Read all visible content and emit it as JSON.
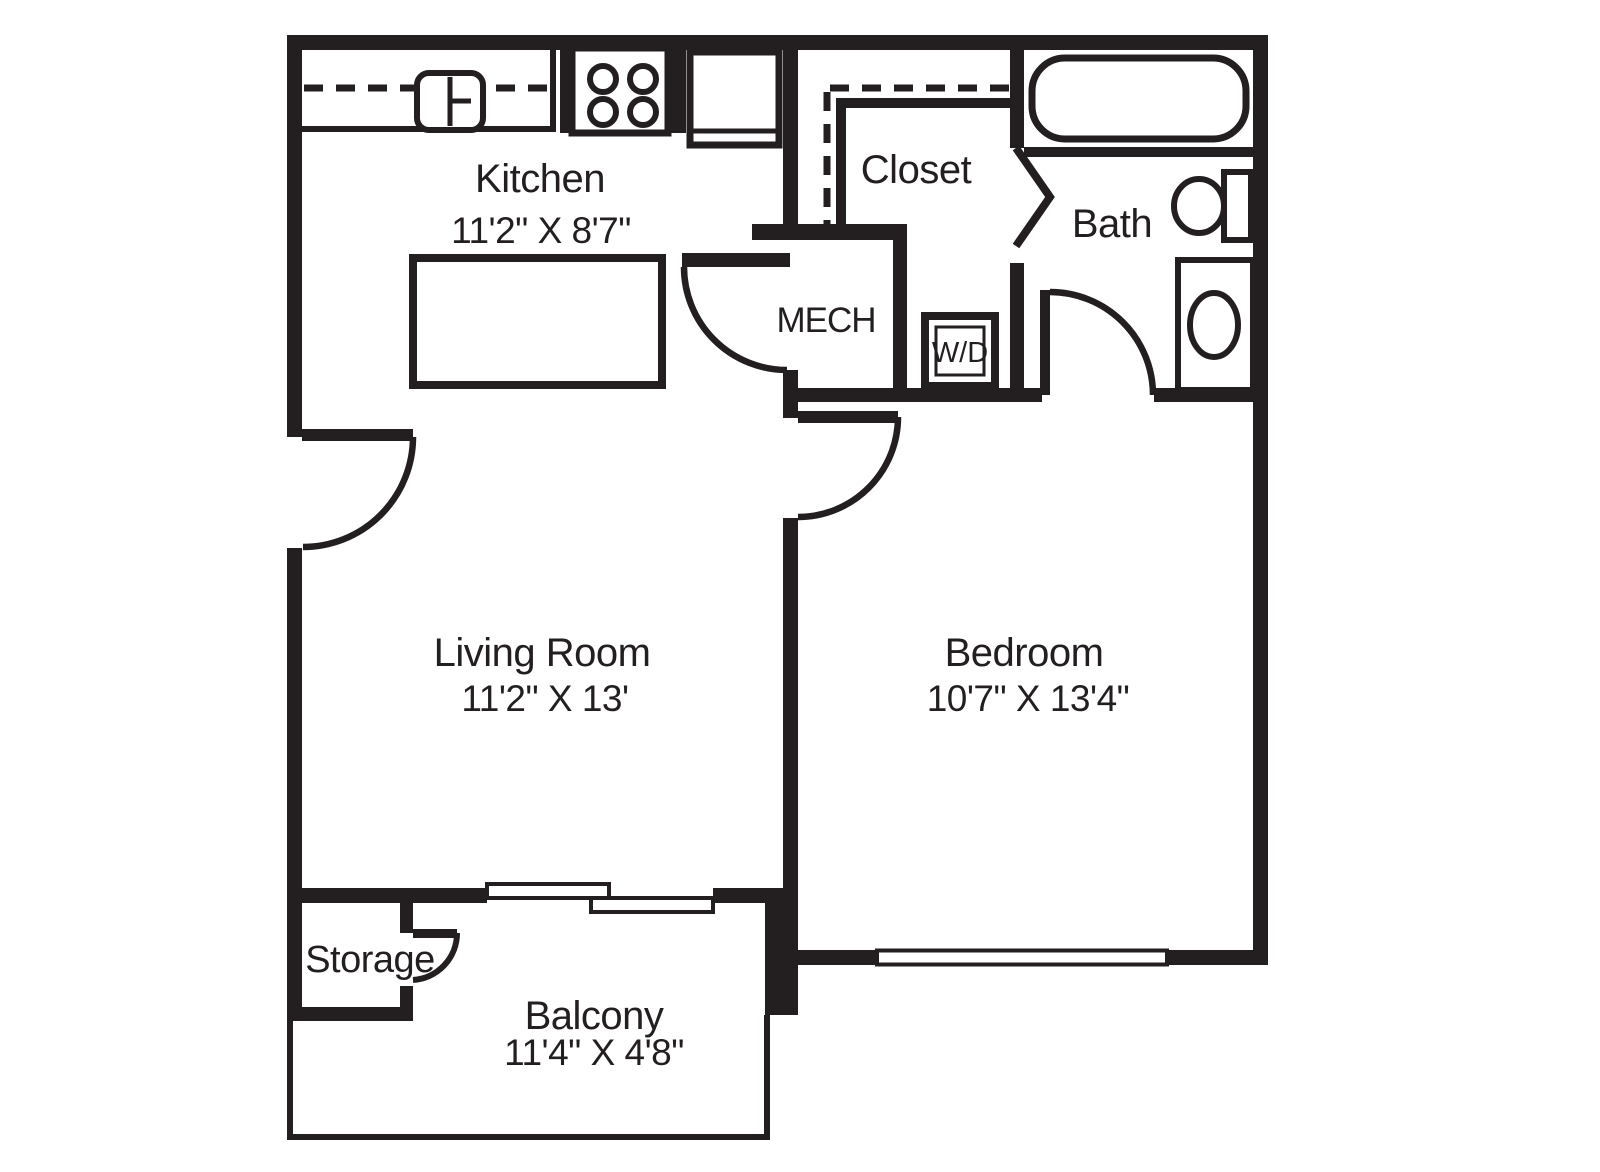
{
  "document": {
    "type": "apartment-floor-plan",
    "style": "black-and-white line drawing"
  },
  "colors": {
    "ink": "#231f20",
    "bg": "#ffffff"
  },
  "rooms": {
    "kitchen": {
      "name": "Kitchen",
      "dims": "11'2\" X 8'7\""
    },
    "living_room": {
      "name": "Living Room",
      "dims": "11'2\" X 13'"
    },
    "bedroom": {
      "name": "Bedroom",
      "dims": "10'7\" X 13'4\""
    },
    "balcony": {
      "name": "Balcony",
      "dims": "11'4\" X 4'8\""
    },
    "closet": {
      "name": "Closet"
    },
    "bath": {
      "name": "Bath"
    },
    "mech": {
      "name": "MECH"
    },
    "storage": {
      "name": "Storage"
    },
    "washer_dryer": {
      "name": "W/D"
    }
  },
  "fixtures": [
    "double-bowl-sink",
    "stove-4-burner",
    "refrigerator",
    "kitchen-island",
    "bathtub",
    "toilet",
    "vanity-sink",
    "washer-dryer-unit",
    "sliding-glass-door",
    "bedroom-window",
    "closet-rod-dashed-line",
    "entry-door",
    "mech-door",
    "bedroom-door",
    "bath-door",
    "storage-door",
    "closet-bifold-door"
  ]
}
